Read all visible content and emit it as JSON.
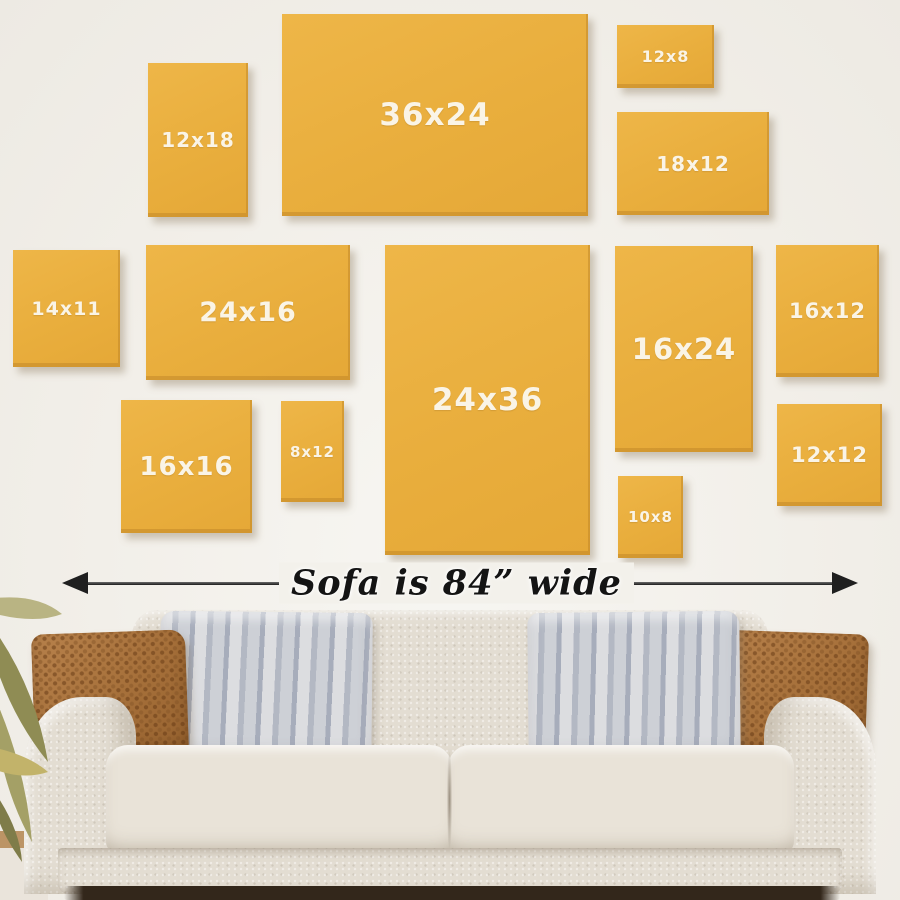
{
  "title": "Wall art size guide above sofa",
  "panels": [
    {
      "id": "12x18",
      "label": "12x18"
    },
    {
      "id": "36x24",
      "label": "36x24"
    },
    {
      "id": "12x8",
      "label": "12x8"
    },
    {
      "id": "18x12",
      "label": "18x12"
    },
    {
      "id": "14x11",
      "label": "14x11"
    },
    {
      "id": "24x16",
      "label": "24x16"
    },
    {
      "id": "24x36",
      "label": "24x36"
    },
    {
      "id": "16x24",
      "label": "16x24"
    },
    {
      "id": "16x12",
      "label": "16x12"
    },
    {
      "id": "16x16",
      "label": "16x16"
    },
    {
      "id": "8x12",
      "label": "8x12"
    },
    {
      "id": "12x12",
      "label": "12x12"
    },
    {
      "id": "10x8",
      "label": "10x8"
    }
  ],
  "measure": {
    "label": "Sofa is 84” wide"
  },
  "colors": {
    "panel_yellow": "#e9ae3d",
    "panel_label": "#faf4e6",
    "wall": "#f2efe9",
    "arrow": "#1f1f1f",
    "sofa_fabric": "#e3ddd2",
    "pillow_brown": "#aa743e",
    "pillow_gray": "#c3c6cc",
    "plant_green": "#8f8c54",
    "floor_tan": "#bc9465",
    "under_sofa_shadow": "#33271b"
  }
}
